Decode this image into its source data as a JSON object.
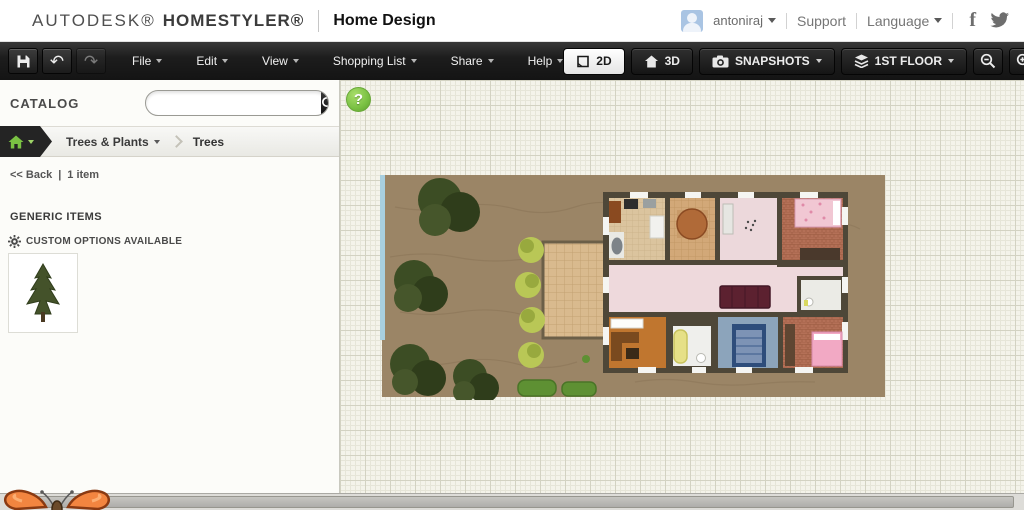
{
  "colors": {
    "accent_green": "#7ac143",
    "toolbar_bg": "#1d1d1d",
    "canvas_bg": "#f4f3ea",
    "garden_dirt": "#9b8566",
    "house_wall": "#4e4738",
    "hall_floor_pink": "#eed9dc",
    "brick_floor": "#b47057",
    "office_floor_orange": "#c0762f",
    "bedroom_floor_blue": "#8ca4bb",
    "tree_green": "#3c4d24",
    "bush_green": "#b9c756",
    "hedge_green": "#5e9033",
    "scrollbar_gray": "#b5b4b0"
  },
  "top_bar": {
    "brand_primary": "AUTODESK®",
    "brand_secondary": "HOMESTYLER®",
    "app_title": "Home Design",
    "username": "antoniraj",
    "support_label": "Support",
    "language_label": "Language",
    "facebook_glyph": "f",
    "googleplus_glyph": "g"
  },
  "toolbar": {
    "menus": [
      "File",
      "Edit",
      "View",
      "Shopping List",
      "Share",
      "Help"
    ],
    "undo_glyph": "↶",
    "redo_glyph": "↷",
    "view_2d_label": "2D",
    "view_3d_label": "3D",
    "snapshots_label": "SNAPSHOTS",
    "floor_label": "1ST FLOOR"
  },
  "sidebar": {
    "catalog_label": "CATALOG",
    "search_value": "",
    "breadcrumb_category": "Trees & Plants",
    "breadcrumb_current": "Trees",
    "back_label": "<< Back",
    "separator": "|",
    "item_count": "1 item",
    "section_title": "GENERIC ITEMS",
    "custom_options_label": "CUSTOM OPTIONS AVAILABLE"
  },
  "canvas": {
    "help_label": "?"
  }
}
